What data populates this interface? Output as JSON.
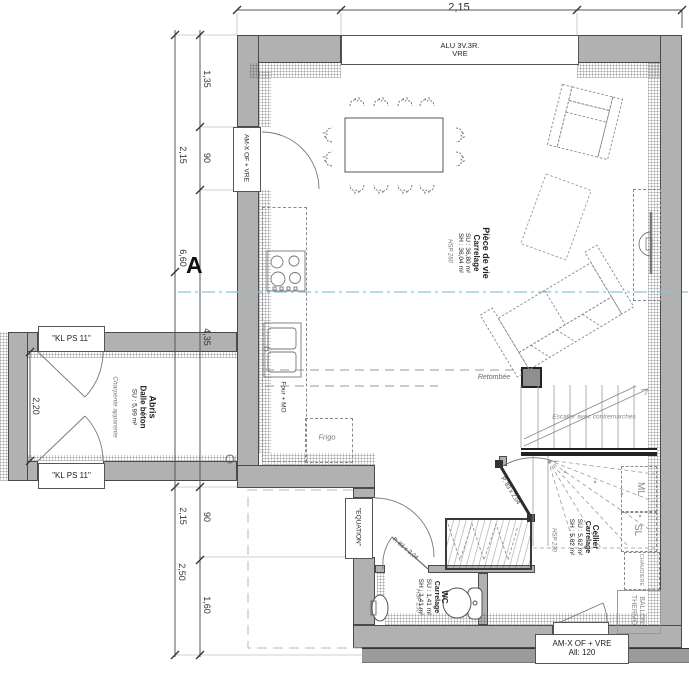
{
  "dims": {
    "top": "2,15",
    "outer": [
      "2,15",
      "6,60",
      "2,15",
      "2,50"
    ],
    "inner": [
      "1,35",
      "90",
      "4,35",
      "90",
      "1,60"
    ],
    "abris": "2,20"
  },
  "windows": {
    "top1": "ALU 3V.3R.",
    "top2": "VRE",
    "left": "AM-X OF + VRE",
    "bottom1": "AM-X OF + VRE",
    "bottom2": "All: 120"
  },
  "doors": {
    "abris_top": "\"KL PS 11\"",
    "abris_bottom": "\"KL PS 11\"",
    "entry": "\"EQUATION\"",
    "cellier": "P. 83 x 2,04",
    "wc": "P. 83 x 2,04"
  },
  "rooms": {
    "living": {
      "name": "Pièce de vie",
      "floor": "Carrelage",
      "su": "SU : 36,80 m²",
      "sh": "SH : 36,04 m²",
      "hsp": "HSP 260"
    },
    "cellier": {
      "name": "Cellier",
      "floor": "Carrelage",
      "su": "SU : 5,62 m²",
      "sh": "SH : 5,62 m²",
      "hsp": "HSP 230"
    },
    "wc": {
      "name": "WC",
      "floor": "Carrelage",
      "su": "SU : 1,41 m²",
      "sh": "SH : 1,41 m²",
      "hsp": "HSP 250"
    },
    "abris": {
      "name": "Abris",
      "floor": "Dalle béton",
      "su": "SU : 5,99 m²",
      "note": "Charpente apparente"
    }
  },
  "annot": {
    "four": "Four + MO",
    "frigo": "Frigo",
    "retombee": "Retombée",
    "stairs": "Escalier avec contremarches",
    "ml": "ML",
    "sl": "SL",
    "chaudiere": "CHAUDIERE",
    "ballon1": "BALLON",
    "ballon2": "THERMO",
    "section": "A"
  },
  "colors": {
    "wall": "#b2b1b1",
    "wall_dark": "#9c9b9b",
    "outline": "#4a4a4a",
    "section_line": "#8fc3e0"
  }
}
